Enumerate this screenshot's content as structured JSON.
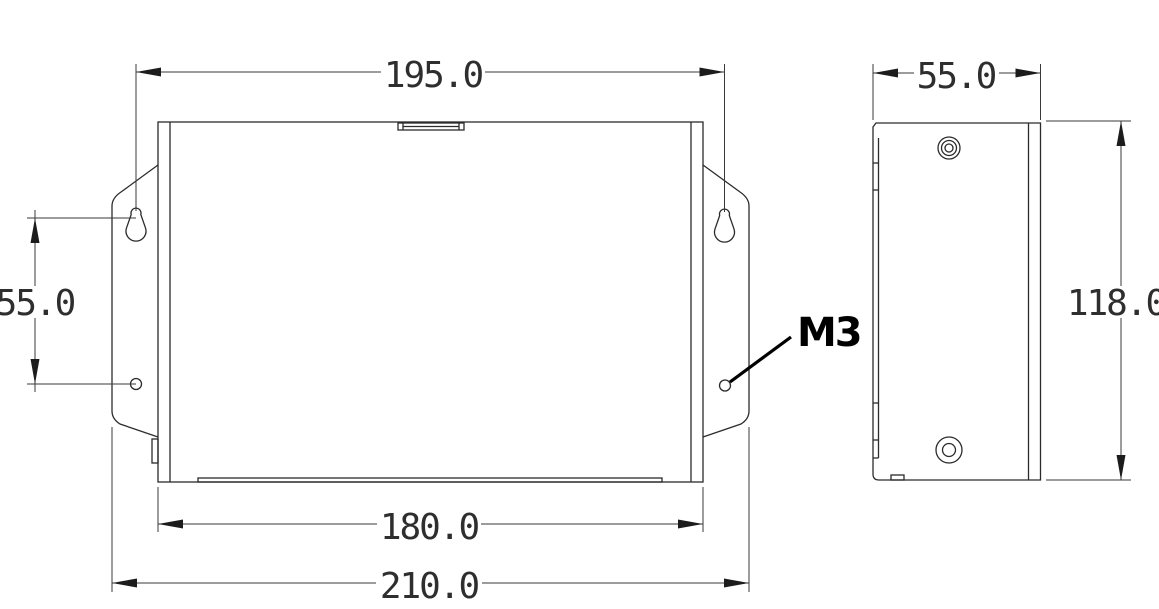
{
  "drawing": {
    "type": "mechanical-dimension-drawing",
    "front_view": {
      "dim_top_width": "195.0",
      "dim_left_hole_spacing": "55.0",
      "dim_body_width": "180.0",
      "dim_overall_width": "210.0",
      "hole_callout": "M3"
    },
    "side_view": {
      "dim_depth": "55.0",
      "dim_height": "118.0"
    },
    "colors": {
      "line": "#2b2b2b",
      "dim_text": "#2e2e2e",
      "callout_text": "#000000",
      "background": "#ffffff"
    }
  }
}
